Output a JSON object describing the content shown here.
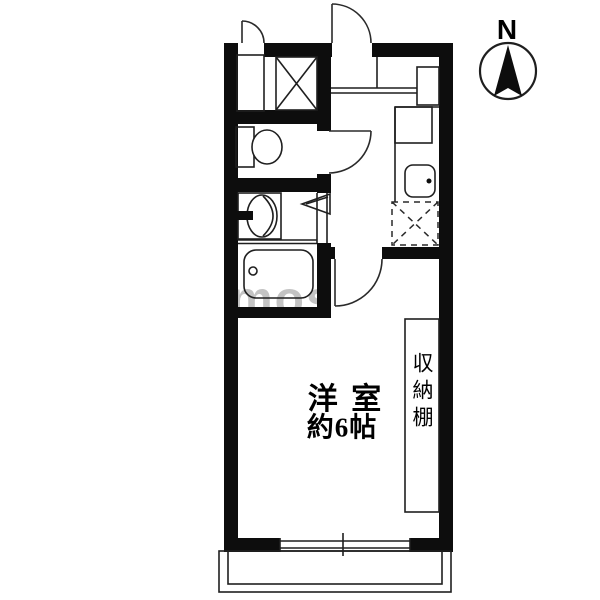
{
  "floorplan": {
    "room": {
      "name_line1": "洋 室",
      "size_line2": "約6帖"
    },
    "storage": {
      "label": "収納棚"
    },
    "compass": {
      "label": "N"
    },
    "watermark": {
      "text": "mos"
    },
    "colors": {
      "wall": "#0d0d0d",
      "line": "#1f1f1f",
      "background": "#ffffff",
      "watermark": "#919191"
    },
    "fixtures": [
      "entrance-door",
      "meter-box-door",
      "pipe-shaft",
      "toilet",
      "washbasin",
      "bathtub",
      "kitchen-counter",
      "kitchen-sink",
      "refrigerator-space",
      "storage-shelf",
      "sliding-window",
      "balcony"
    ]
  }
}
